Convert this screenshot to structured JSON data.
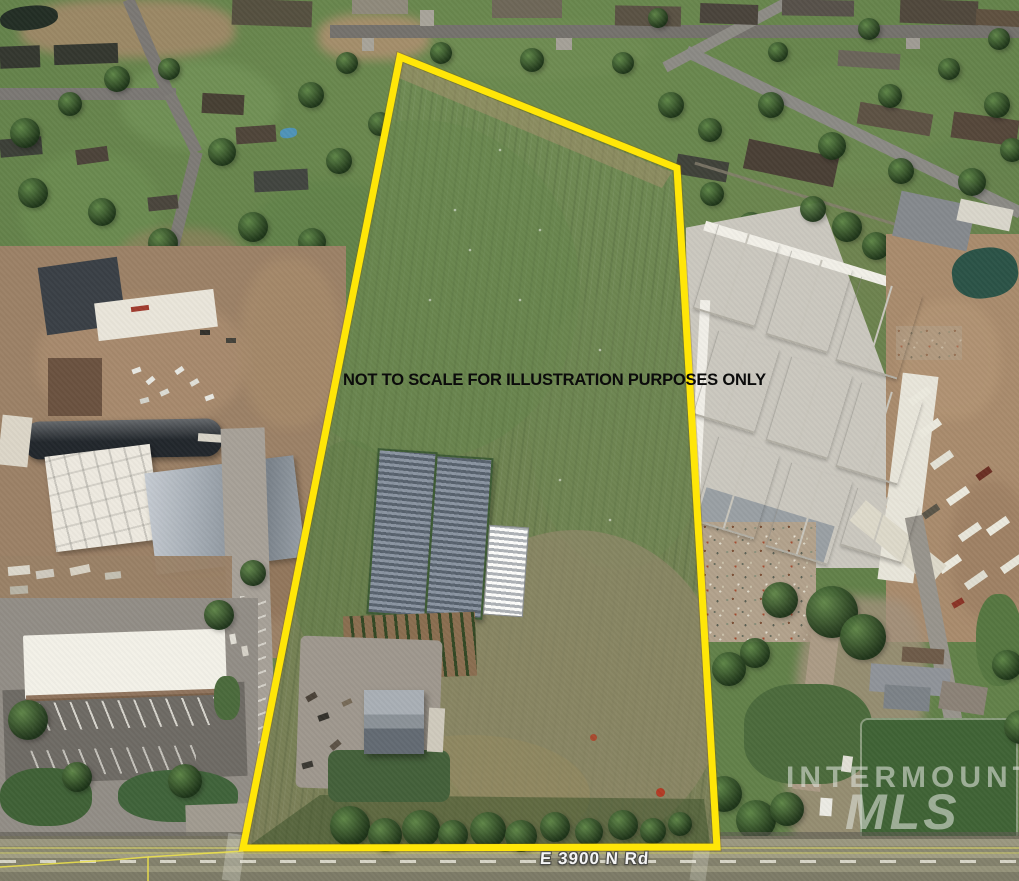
{
  "annotations": {
    "disclaimer": "NOT TO SCALE FOR ILLUSTRATION PURPOSES ONLY",
    "road_label": "E 3900 N Rd",
    "watermark": {
      "line1": "INTERMOUNTAIN",
      "line2": "MLS"
    }
  },
  "parcel": {
    "boundary_points": "400,57 677,168 717,847 243,848",
    "secondary_lines": [
      "0,867 112,860 148,857 148,881",
      "148,857 243,851"
    ]
  },
  "colors": {
    "boundary_yellow": "#FFE608",
    "boundary_shadow": "rgba(120,90,0,0.30)",
    "secondary_line_yellow": "#EFE34A",
    "disclaimer_text": "#0B0B0B",
    "road_label_text": "#F4F4F4",
    "road_label_outline": "#4A4A46",
    "watermark_text": "rgba(224,228,221,0.58)"
  }
}
